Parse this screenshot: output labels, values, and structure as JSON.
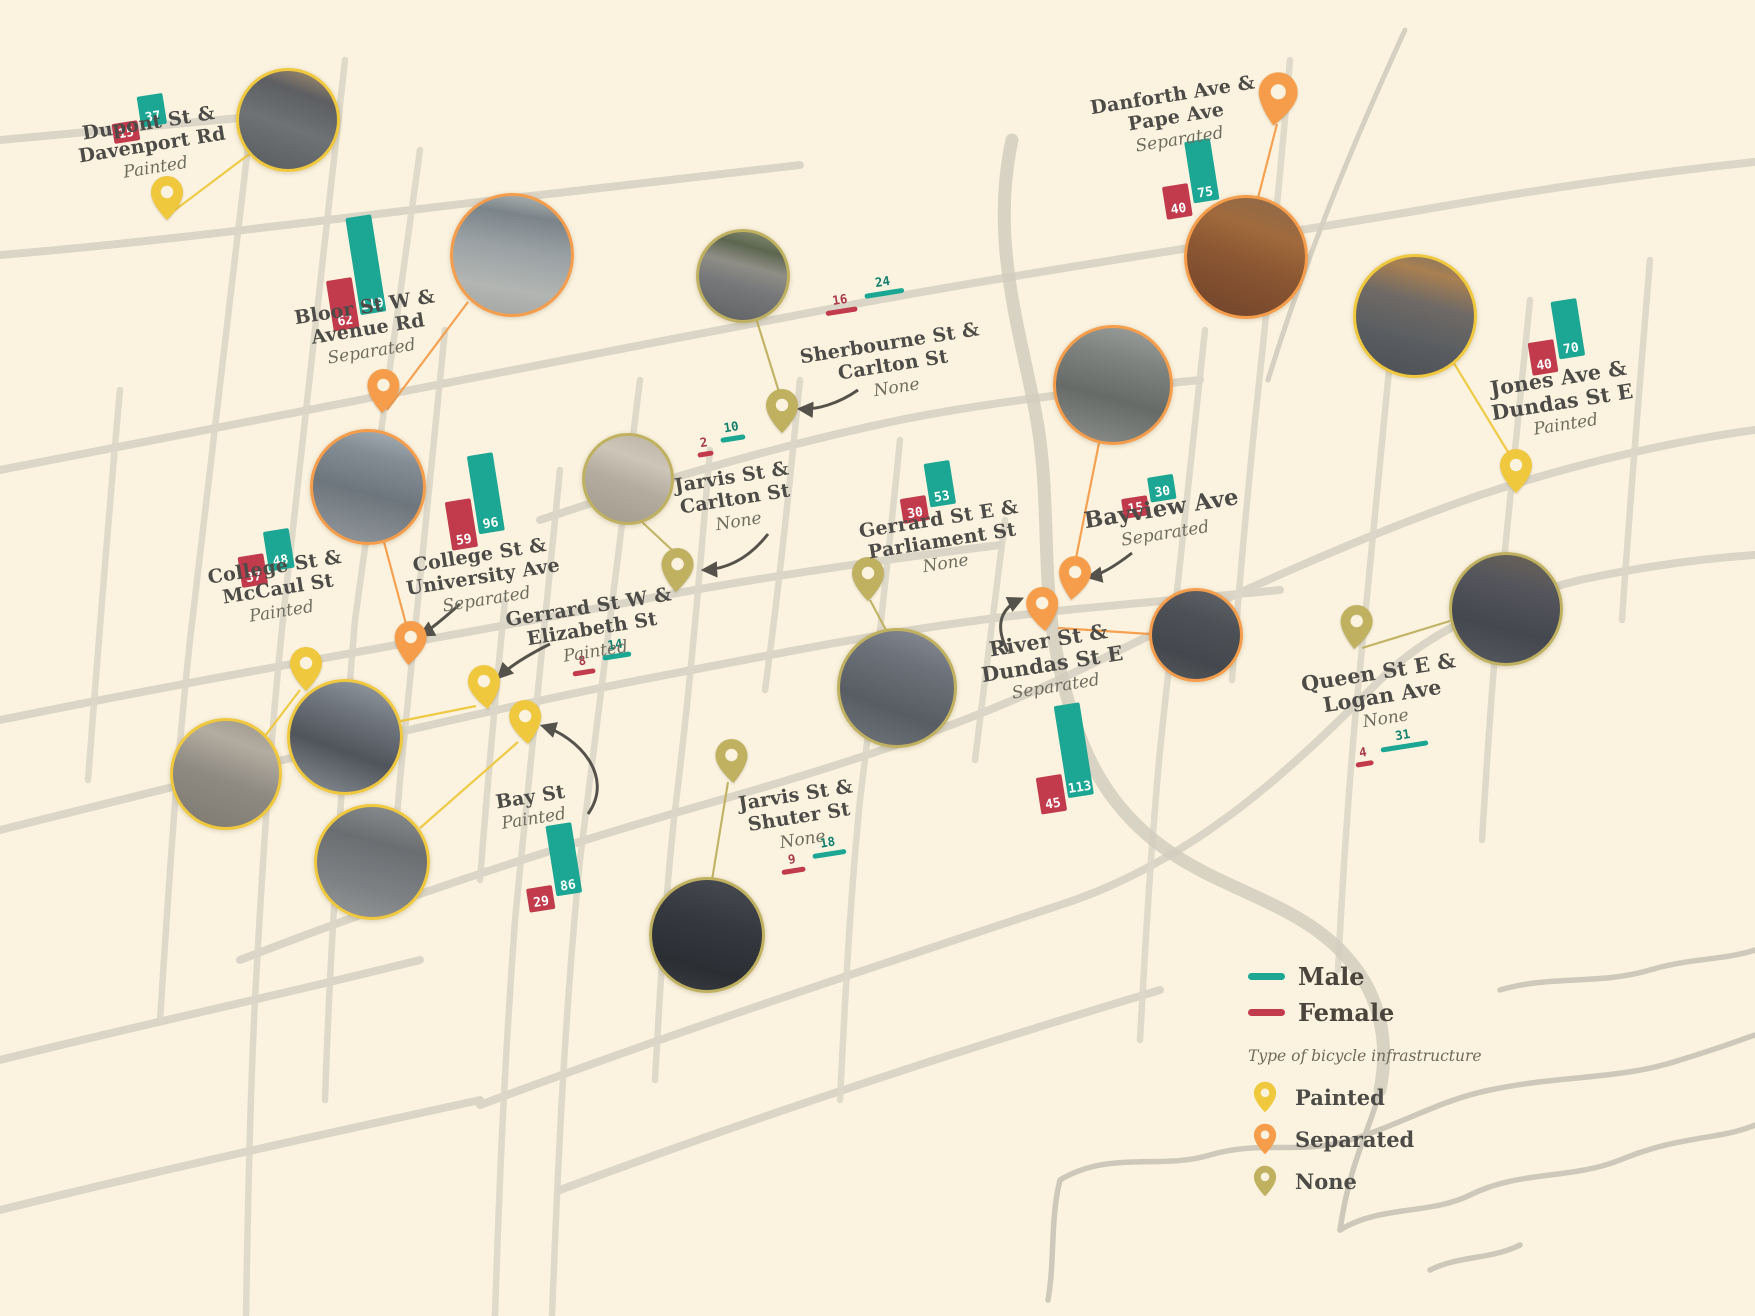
{
  "legend": {
    "male_label": "Male",
    "female_label": "Female",
    "infrastructure_title": "Type of bicycle infrastructure",
    "types": [
      {
        "label": "Painted",
        "key": "painted"
      },
      {
        "label": "Separated",
        "key": "separated"
      },
      {
        "label": "None",
        "key": "none"
      }
    ]
  },
  "colors": {
    "male": "#1CA794",
    "female": "#C23B4D",
    "painted": "#EFC83E",
    "separated": "#F59D4A",
    "none": "#C0B161",
    "background": "#FBF3DF",
    "roads": "#D9D4C5",
    "label_text": "#4D4B47"
  },
  "locations": [
    {
      "id": "dupont-davenport",
      "name_lines": [
        "Dupont St &",
        "Davenport Rd"
      ],
      "infrastructure": "Painted",
      "female": 15,
      "male": 37,
      "bar_style": "block"
    },
    {
      "id": "bloor-avenue",
      "name_lines": [
        "Bloor St W &",
        "Avenue Rd"
      ],
      "infrastructure": "Separated",
      "female": 62,
      "male": 119,
      "bar_style": "block"
    },
    {
      "id": "sherbourne-carlton",
      "name_lines": [
        "Sherbourne St &",
        "Carlton St"
      ],
      "infrastructure": "None",
      "female": 16,
      "male": 24,
      "bar_style": "underline"
    },
    {
      "id": "danforth-pape",
      "name_lines": [
        "Danforth Ave &",
        "Pape Ave"
      ],
      "infrastructure": "Separated",
      "female": 40,
      "male": 75,
      "bar_style": "block"
    },
    {
      "id": "jones-dundas",
      "name_lines": [
        "Jones Ave &",
        "Dundas St E"
      ],
      "infrastructure": "Painted",
      "female": 40,
      "male": 70,
      "bar_style": "block"
    },
    {
      "id": "college-mccaul",
      "name_lines": [
        "College St &",
        "McCaul St"
      ],
      "infrastructure": "Painted",
      "female": 37,
      "male": 48,
      "bar_style": "block"
    },
    {
      "id": "college-university",
      "name_lines": [
        "College St &",
        "University Ave"
      ],
      "infrastructure": "Separated",
      "female": 59,
      "male": 96,
      "bar_style": "block"
    },
    {
      "id": "gerrard-elizabeth",
      "name_lines": [
        "Gerrard St W &",
        "Elizabeth St"
      ],
      "infrastructure": "Painted",
      "female": 8,
      "male": 14,
      "bar_style": "underline"
    },
    {
      "id": "bay",
      "name_lines": [
        "Bay St"
      ],
      "infrastructure": "Painted",
      "female": 29,
      "male": 86,
      "bar_style": "block"
    },
    {
      "id": "jarvis-carlton",
      "name_lines": [
        "Jarvis St &",
        "Carlton St"
      ],
      "infrastructure": "None",
      "female": 2,
      "male": 10,
      "bar_style": "underline"
    },
    {
      "id": "jarvis-shuter",
      "name_lines": [
        "Jarvis St &",
        "Shuter St"
      ],
      "infrastructure": "None",
      "female": 9,
      "male": 18,
      "bar_style": "underline"
    },
    {
      "id": "gerrard-parliament",
      "name_lines": [
        "Gerrard St E &",
        "Parliament St"
      ],
      "infrastructure": "None",
      "female": 30,
      "male": 53,
      "bar_style": "block"
    },
    {
      "id": "bayview",
      "name_lines": [
        "Bayview Ave"
      ],
      "infrastructure": "Separated",
      "female": 15,
      "male": 30,
      "bar_style": "block"
    },
    {
      "id": "river-dundas",
      "name_lines": [
        "River St &",
        "Dundas St E"
      ],
      "infrastructure": "Separated",
      "female": 45,
      "male": 113,
      "bar_style": "block"
    },
    {
      "id": "queen-logan",
      "name_lines": [
        "Queen St E &",
        "Logan Ave"
      ],
      "infrastructure": "None",
      "female": 4,
      "male": 31,
      "bar_style": "underline"
    }
  ]
}
